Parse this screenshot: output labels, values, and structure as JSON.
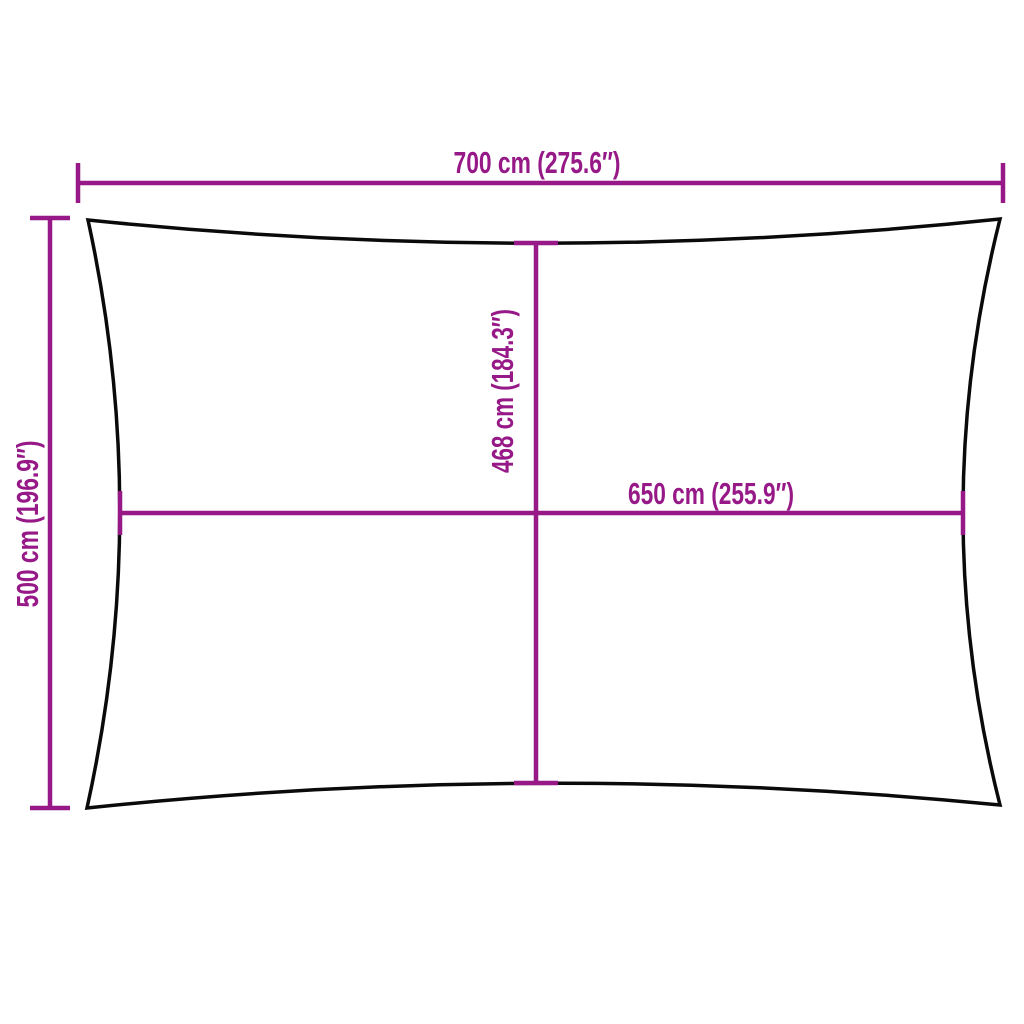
{
  "page": {
    "background": "#ffffff"
  },
  "diagram": {
    "outline_color": "#0a0a0a",
    "dimension_color": "#961987",
    "dimensions": {
      "top_width": "700 cm (275.6″)",
      "left_height": "500 cm (196.9″)",
      "inner_height": "468 cm (184.3″)",
      "inner_width": "650 cm (255.9″)"
    }
  }
}
